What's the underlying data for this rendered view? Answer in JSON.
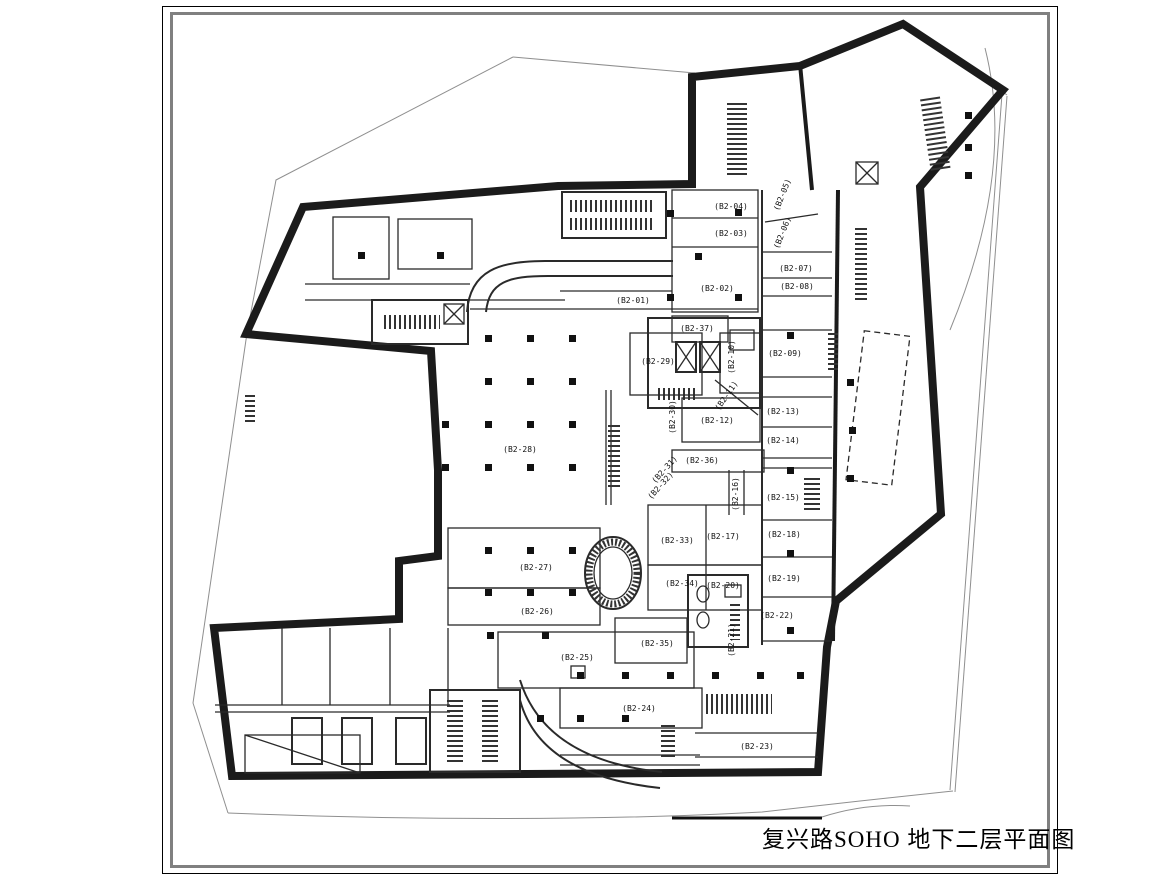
{
  "sheet": {
    "title": "复兴路SOHO 地下二层平面图",
    "project": "复兴路SOHO",
    "floor": "地下二层平面图"
  },
  "plan": {
    "colors": {
      "wall": "#1b1b1b",
      "partition": "#2a2a2a",
      "boundary": "#8f8f8f",
      "paper": "#ffffff",
      "frame_inner": "#808080"
    },
    "rooms": [
      {
        "id": "B2-01",
        "label": "(B2-01)"
      },
      {
        "id": "B2-02",
        "label": "(B2-02)"
      },
      {
        "id": "B2-03",
        "label": "(B2-03)"
      },
      {
        "id": "B2-04",
        "label": "(B2-04)"
      },
      {
        "id": "B2-05",
        "label": "(B2-05)"
      },
      {
        "id": "B2-06",
        "label": "(B2-06)"
      },
      {
        "id": "B2-07",
        "label": "(B2-07)"
      },
      {
        "id": "B2-08",
        "label": "(B2-08)"
      },
      {
        "id": "B2-09",
        "label": "(B2-09)"
      },
      {
        "id": "B2-10",
        "label": "(B2-10)"
      },
      {
        "id": "B2-11",
        "label": "(B2-11)"
      },
      {
        "id": "B2-12",
        "label": "(B2-12)"
      },
      {
        "id": "B2-13",
        "label": "(B2-13)"
      },
      {
        "id": "B2-14",
        "label": "(B2-14)"
      },
      {
        "id": "B2-15",
        "label": "(B2-15)"
      },
      {
        "id": "B2-16",
        "label": "(B2-16)"
      },
      {
        "id": "B2-17",
        "label": "(B2-17)"
      },
      {
        "id": "B2-18",
        "label": "(B2-18)"
      },
      {
        "id": "B2-19",
        "label": "(B2-19)"
      },
      {
        "id": "B2-20",
        "label": "(B2-20)"
      },
      {
        "id": "B2-21",
        "label": "(B2-21)"
      },
      {
        "id": "B2-22",
        "label": "(B2-22)"
      },
      {
        "id": "B2-23",
        "label": "(B2-23)"
      },
      {
        "id": "B2-24",
        "label": "(B2-24)"
      },
      {
        "id": "B2-25",
        "label": "(B2-25)"
      },
      {
        "id": "B2-26",
        "label": "(B2-26)"
      },
      {
        "id": "B2-27",
        "label": "(B2-27)"
      },
      {
        "id": "B2-28",
        "label": "(B2-28)"
      },
      {
        "id": "B2-29",
        "label": "(B2-29)"
      },
      {
        "id": "B2-30",
        "label": "(B2-30)"
      },
      {
        "id": "B2-31",
        "label": "(B2-31)"
      },
      {
        "id": "B2-32",
        "label": "(B2-32)"
      },
      {
        "id": "B2-33",
        "label": "(B2-33)"
      },
      {
        "id": "B2-34",
        "label": "(B2-34)"
      },
      {
        "id": "B2-35",
        "label": "(B2-35)"
      },
      {
        "id": "B2-36",
        "label": "(B2-36)"
      },
      {
        "id": "B2-37",
        "label": "(B2-37)"
      }
    ]
  }
}
